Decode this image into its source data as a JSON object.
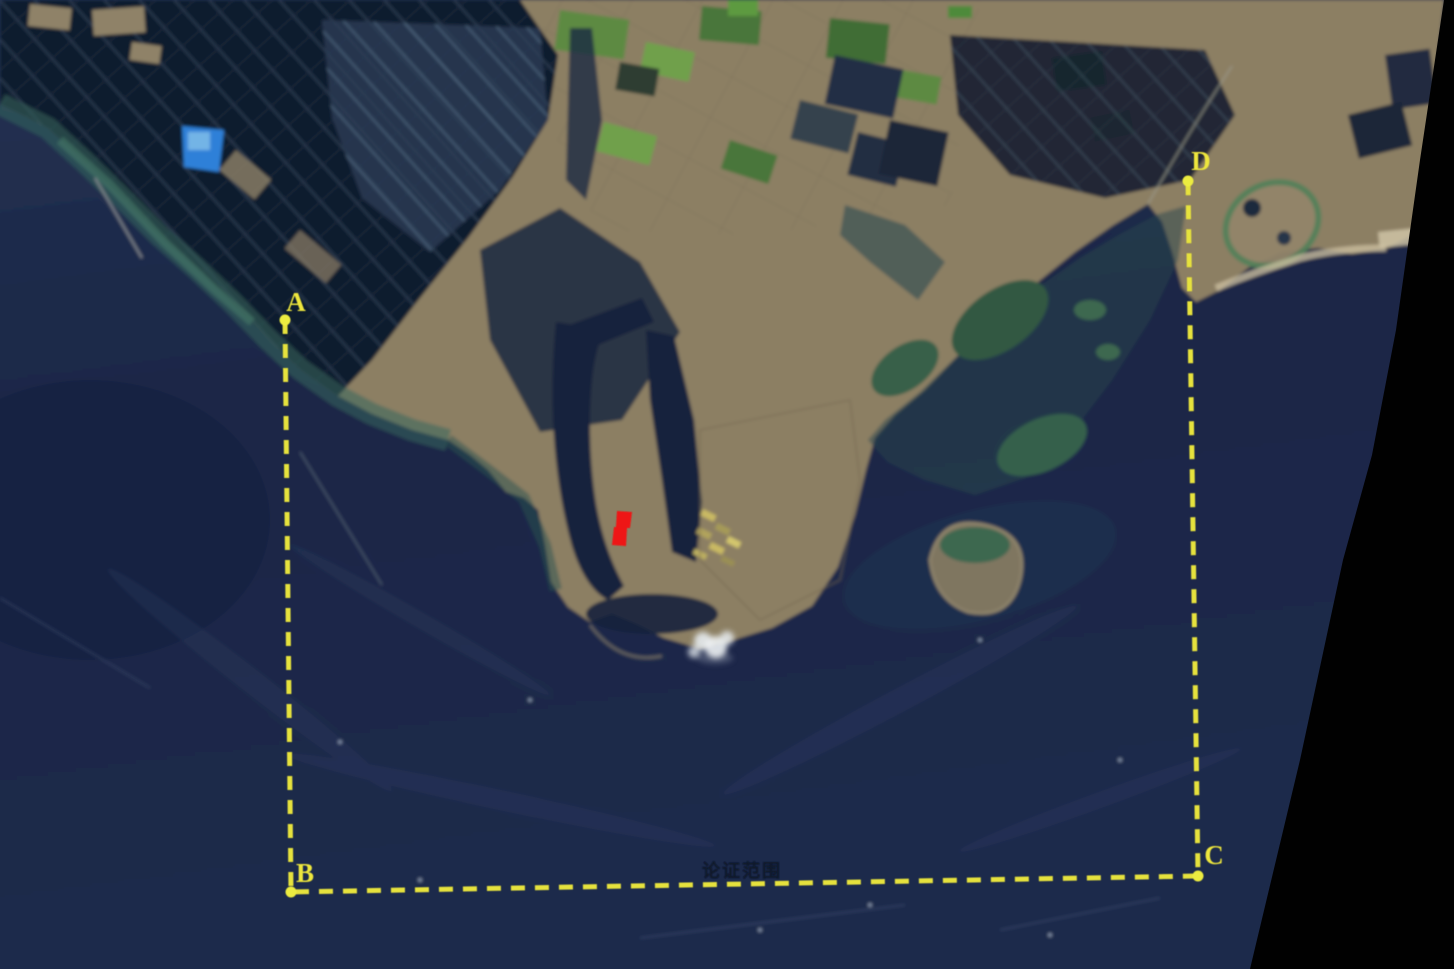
{
  "scene": {
    "kind": "satellite-remote-sensing-image",
    "subject": "coastal harbor and aquaculture area with sea-area demonstration boundary",
    "width_px": 1454,
    "height_px": 969
  },
  "annotations": {
    "boundary": {
      "style": "dashed",
      "color": "#e6e23c",
      "open_side": "top",
      "vertex_order": "A-B-C-D"
    },
    "corner_labels": {
      "a": "A",
      "b": "B",
      "c": "C",
      "d": "D"
    },
    "caption": {
      "text": "论证范围",
      "color": "#0a1426"
    },
    "project_marker": {
      "color": "#ee1414",
      "description": "small red site polygon on port pier"
    }
  },
  "palette": {
    "sea": "#1c2a4a",
    "sea_deep": "#152140",
    "land": "#8c7f64",
    "aquaculture_ponds": "#111a2d",
    "pond_stripe_light": "#5f7d96",
    "bright_blue_pond": "#2f80d8",
    "shallow_water_teal": "#2f5d55",
    "marsh_green": "#3c6850",
    "farm_green": "#5d8a42",
    "no_data_black": "#010101",
    "boundary_yellow": "#e6e23c",
    "marker_red": "#ee1414",
    "cloud_white": "#e6ebee"
  }
}
